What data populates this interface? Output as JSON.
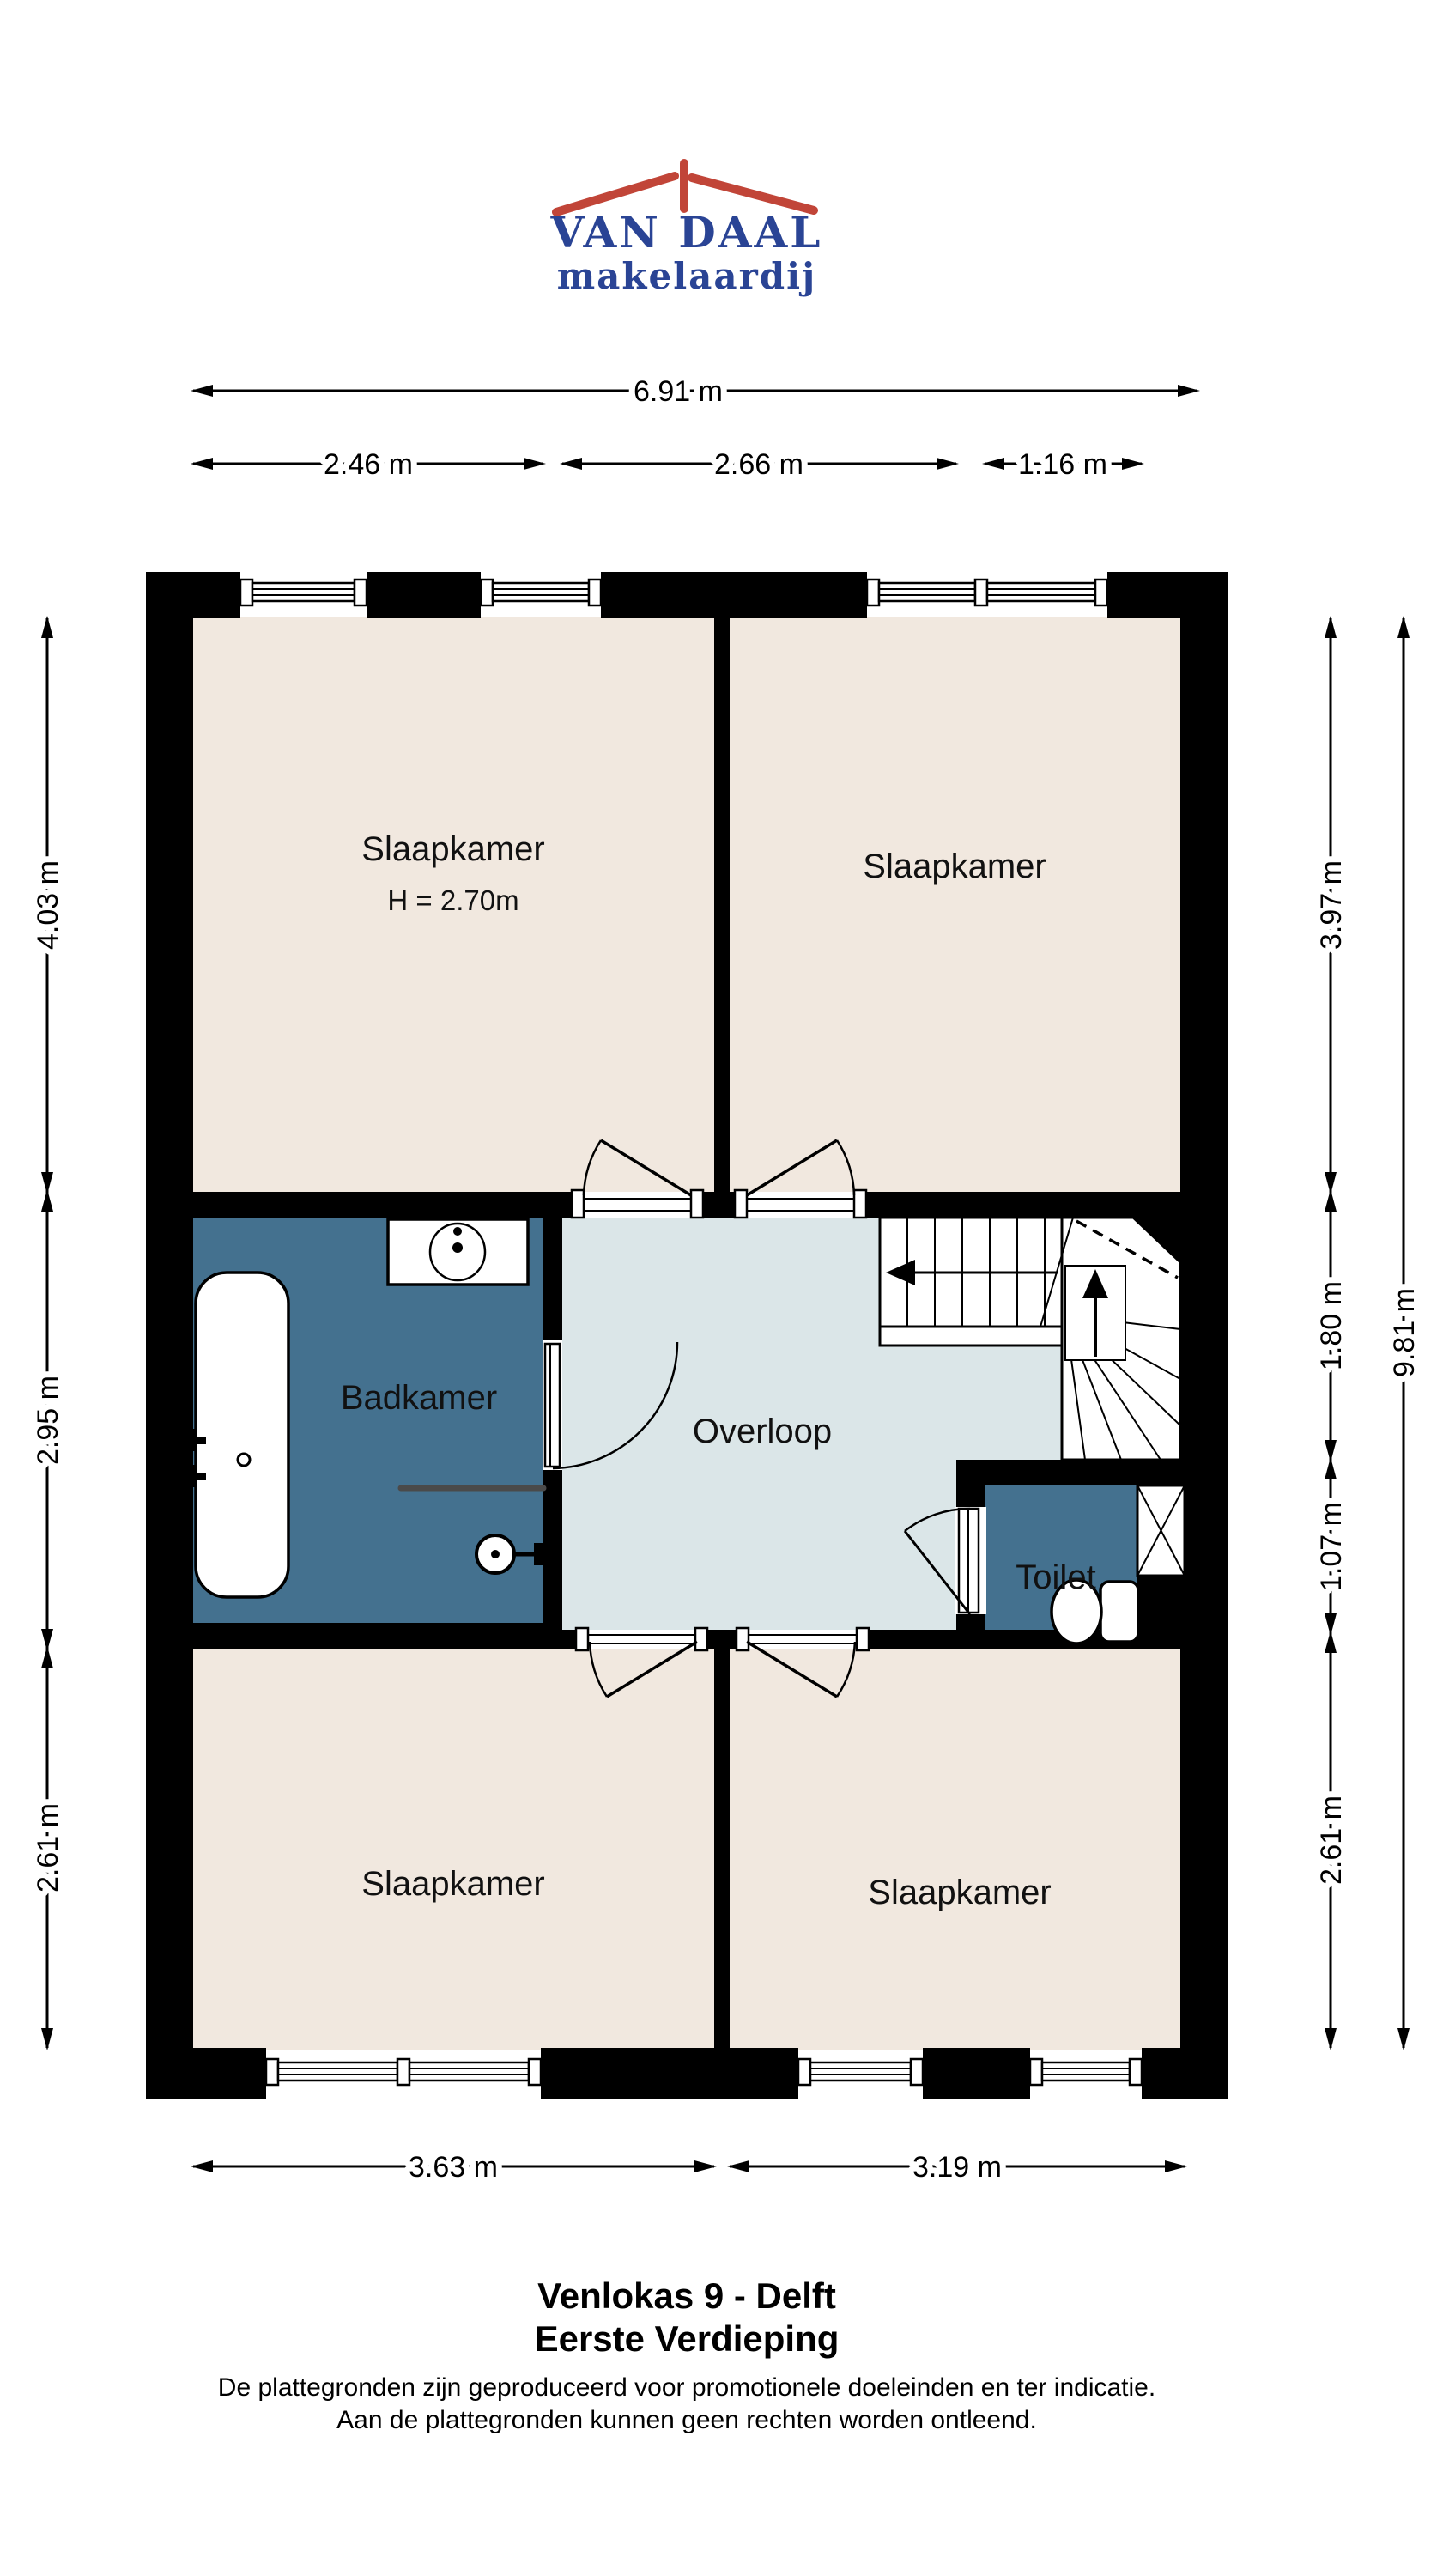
{
  "logo": {
    "name": "VAN DAAL",
    "tagline": "makelaardij"
  },
  "rooms": {
    "bedroom_top_left": {
      "label": "Slaapkamer",
      "height_note": "H = 2.70m"
    },
    "bedroom_top_right": {
      "label": "Slaapkamer"
    },
    "bathroom": {
      "label": "Badkamer"
    },
    "landing": {
      "label": "Overloop"
    },
    "toilet": {
      "label": "Toilet"
    },
    "bedroom_bottom_left": {
      "label": "Slaapkamer"
    },
    "bedroom_bottom_right": {
      "label": "Slaapkamer"
    }
  },
  "dimensions": {
    "top_total": "6.91 m",
    "top_left": "2.46 m",
    "top_middle": "2.66 m",
    "top_right": "1.16 m",
    "left_top": "4.03 m",
    "left_middle": "2.95 m",
    "left_bottom": "2.61 m",
    "right_top": "3.97 m",
    "right_stairs": "1.80 m",
    "right_toilet": "1.07 m",
    "right_bottom": "2.61 m",
    "right_total": "9.81 m",
    "bottom_left": "3.63 m",
    "bottom_right": "3.19 m"
  },
  "title": {
    "address": "Venlokas 9 - Delft",
    "floor": "Eerste Verdieping",
    "disclaimer_line1": "De plattegronden zijn geproduceerd voor promotionele doeleinden en ter indicatie.",
    "disclaimer_line2": "Aan de plattegronden kunnen geen rechten worden ontleend."
  },
  "colors": {
    "wall": "#000000",
    "bedroom-floor": "#f1e8df",
    "bathroom-floor": "#44718f",
    "landing-floor": "#dbe6e8",
    "logo-blue": "#2a4495",
    "logo-red": "#c14538"
  }
}
